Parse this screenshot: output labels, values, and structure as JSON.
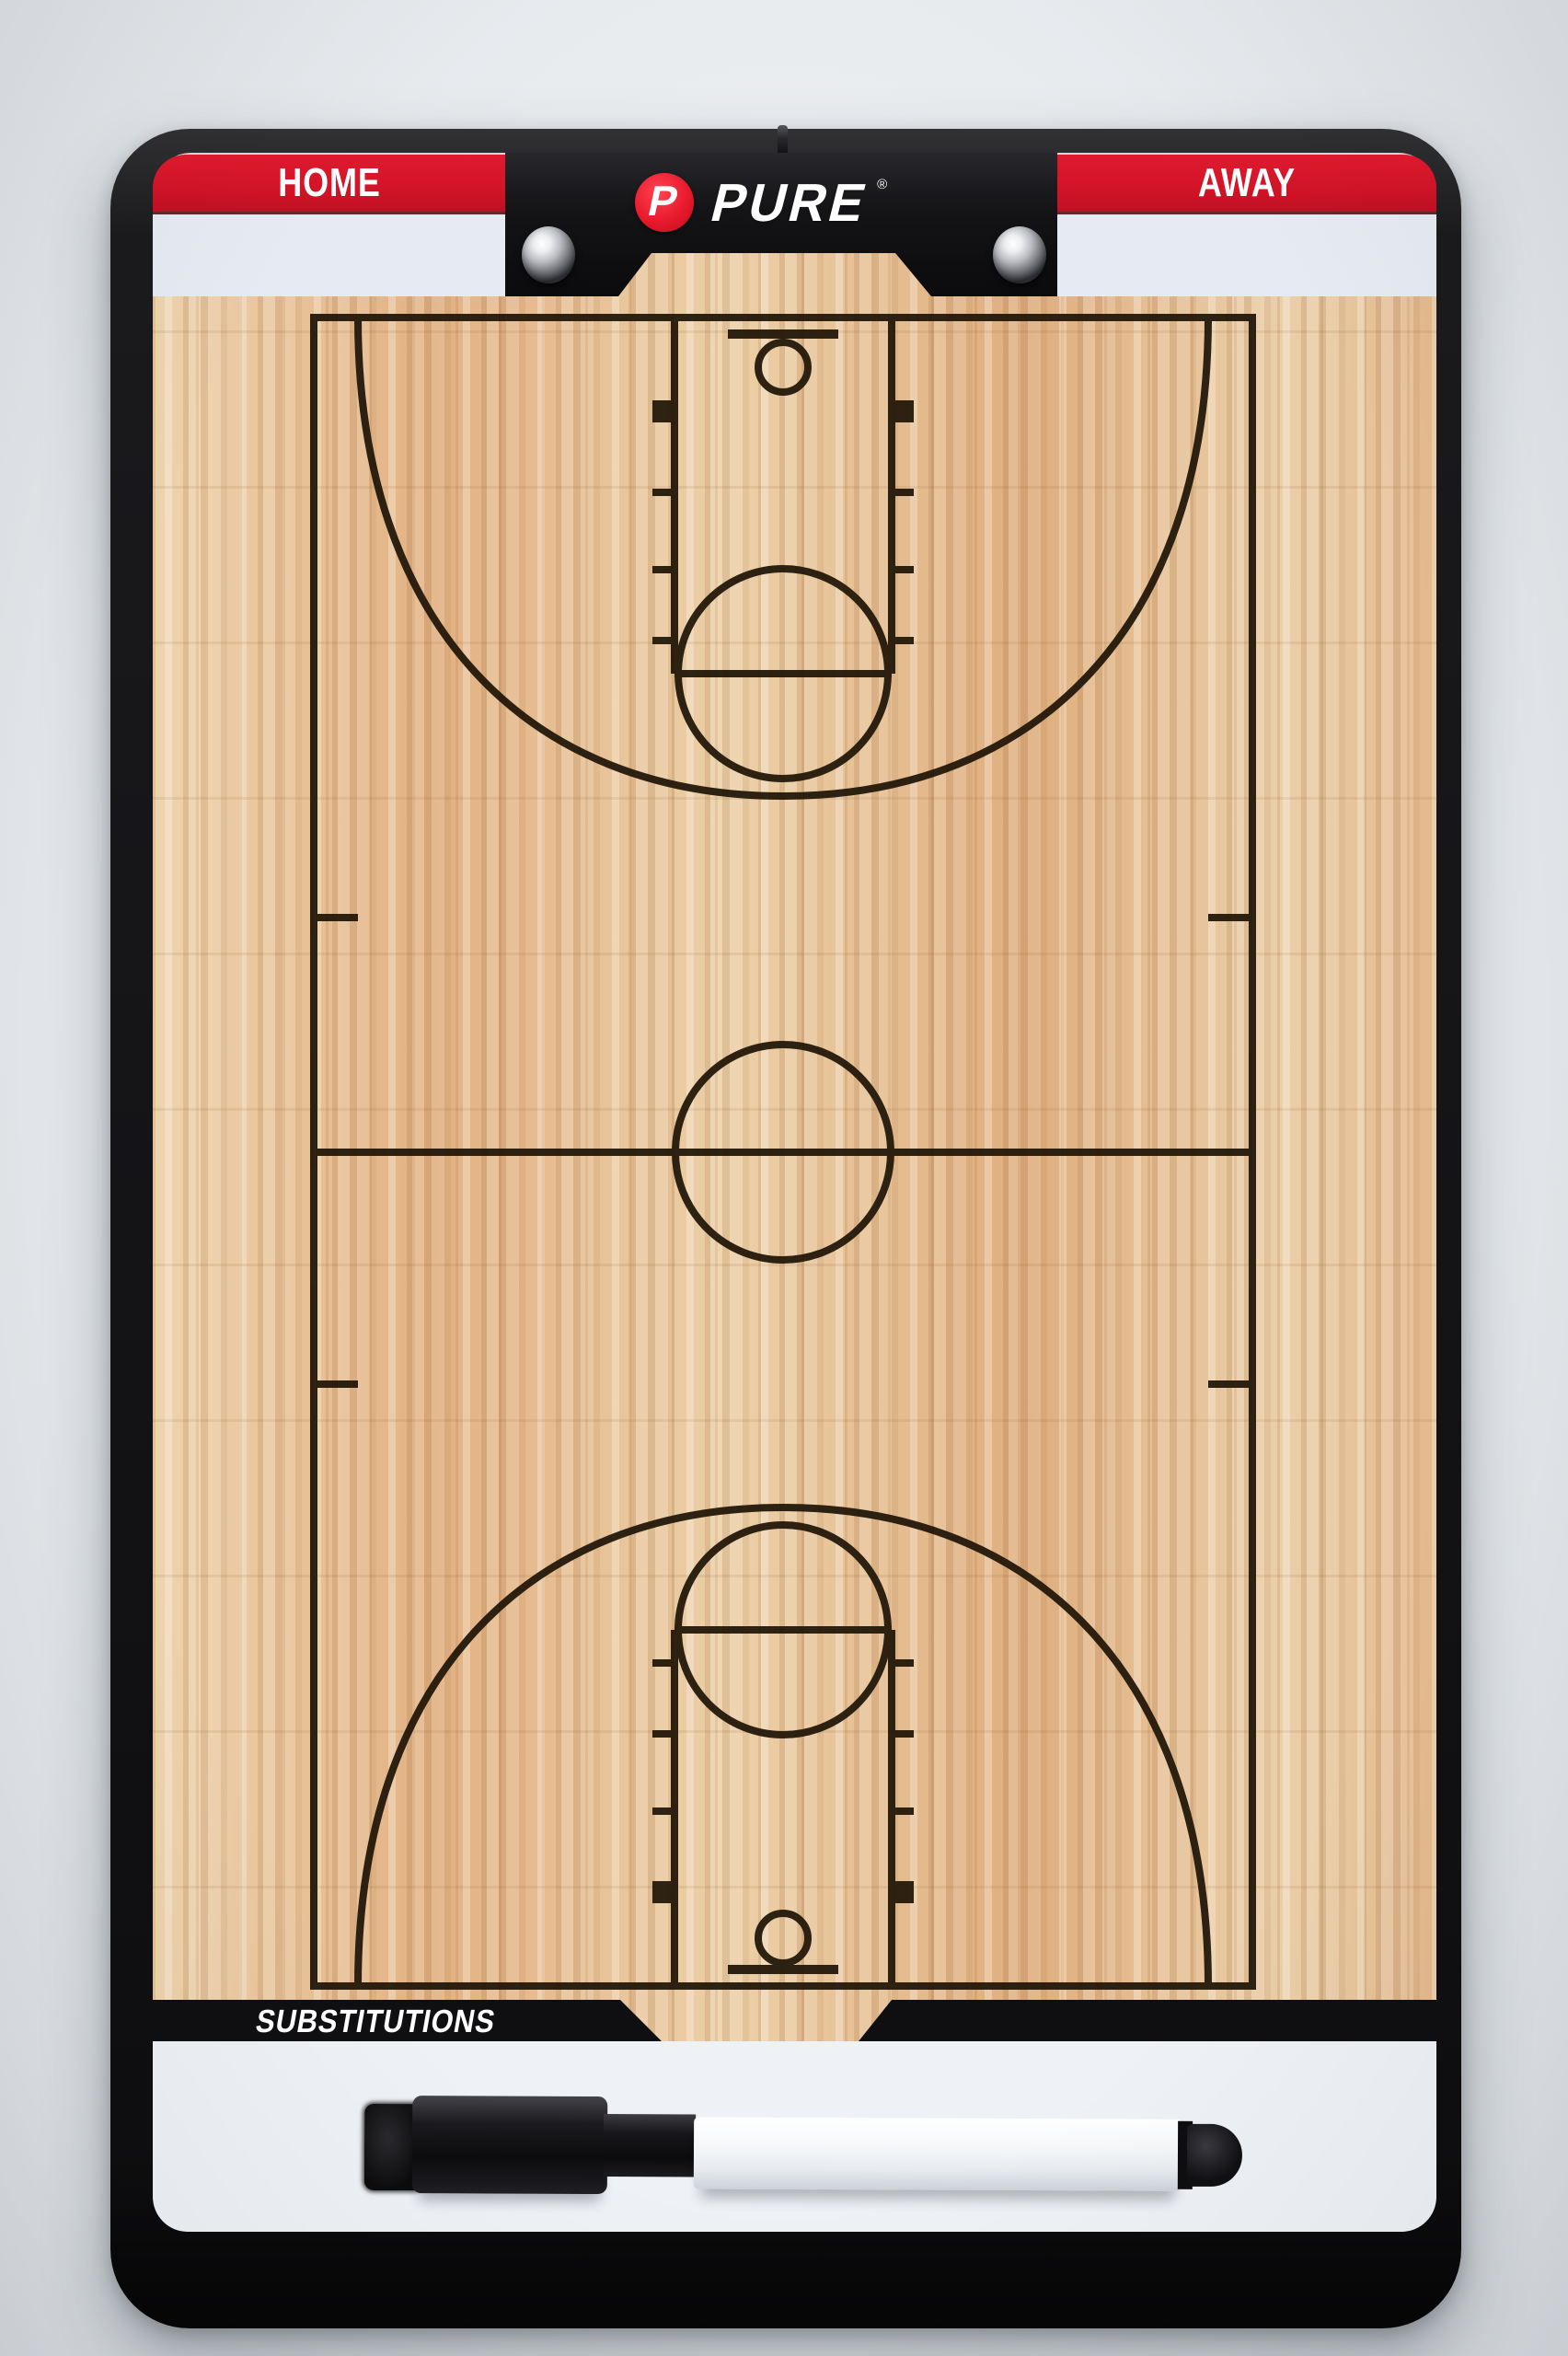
{
  "brand": {
    "initial": "P",
    "name": "PURE",
    "registered": "®"
  },
  "header": {
    "home_label": "HOME",
    "away_label": "AWAY"
  },
  "footer": {
    "substitutions_label": "SUBSTITUTIONS"
  },
  "colors": {
    "accent_red": "#d21428",
    "frame_black": "#141417",
    "face_white": "#e9edf2",
    "wood_base": "#e5bc90",
    "court_line": "#221709",
    "marker_barrel": "#f4f6f8",
    "marker_cap": "#131316"
  },
  "objects": {
    "rivet_count": 2,
    "marker_pen_present": true
  }
}
